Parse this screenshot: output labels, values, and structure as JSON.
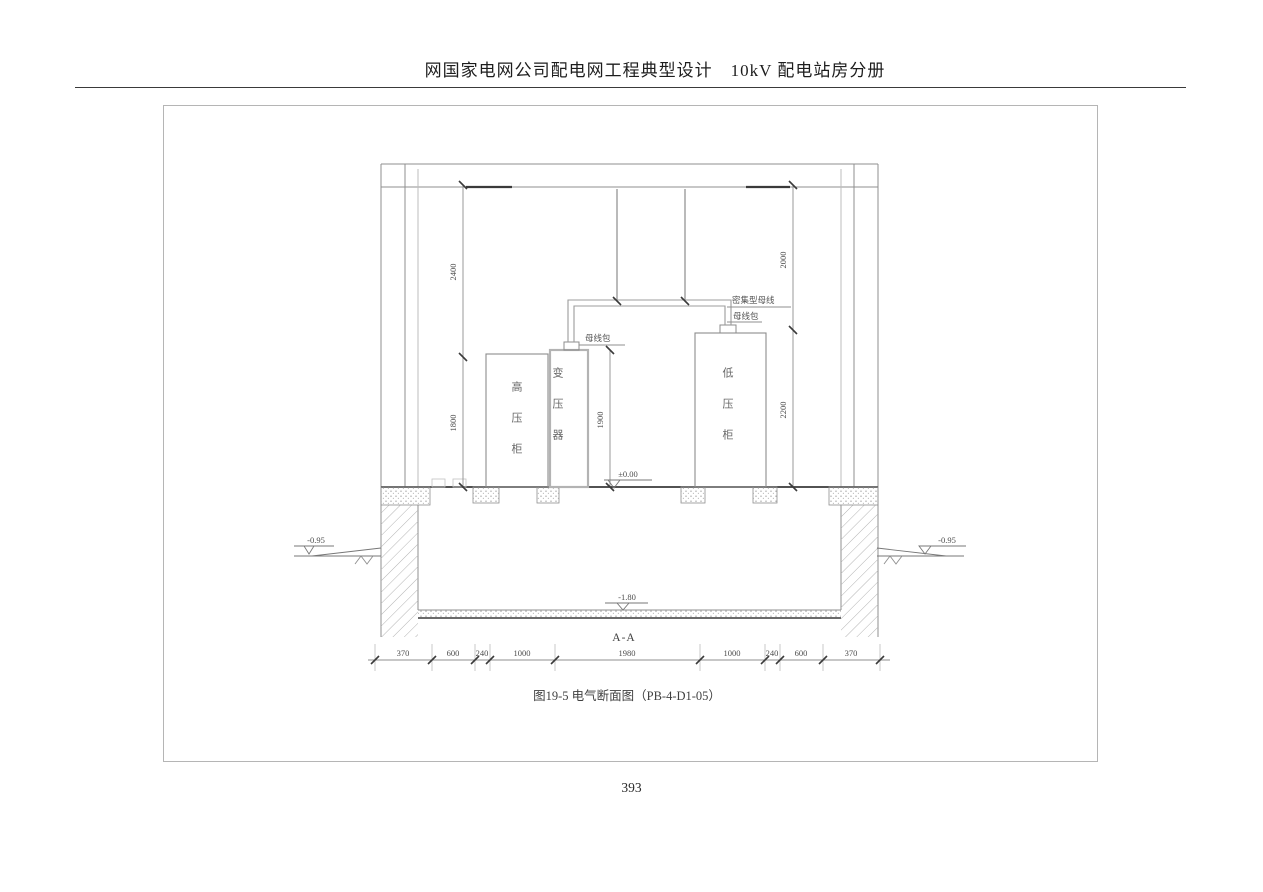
{
  "page": {
    "header_title": "网国家电网公司配电网工程典型设计　10kV 配电站房分册",
    "figure_caption": "图19-5 电气断面图（PB-4-D1-05）",
    "page_number": "393"
  },
  "drawing": {
    "section_label": "A-A",
    "equipment": {
      "hv_cabinet": "高压柜",
      "transformer": "变压器",
      "lv_cabinet": "低压柜"
    },
    "annotations": {
      "dense_busway": "密集型母线",
      "bus_wrap_upper": "母线包",
      "bus_wrap_lower": "母线包"
    },
    "levels": {
      "floor": "±0.00",
      "ground_left": "-0.95",
      "ground_right": "-0.95",
      "trench_bottom": "-1.80"
    },
    "dimensions": {
      "left_upper": "2400",
      "left_lower": "1800",
      "transformer_height": "1900",
      "right_upper": "2000",
      "right_lower": "2200",
      "bottom": [
        "370",
        "600",
        "240",
        "1000",
        "1980",
        "1000",
        "240",
        "600",
        "370"
      ]
    }
  }
}
